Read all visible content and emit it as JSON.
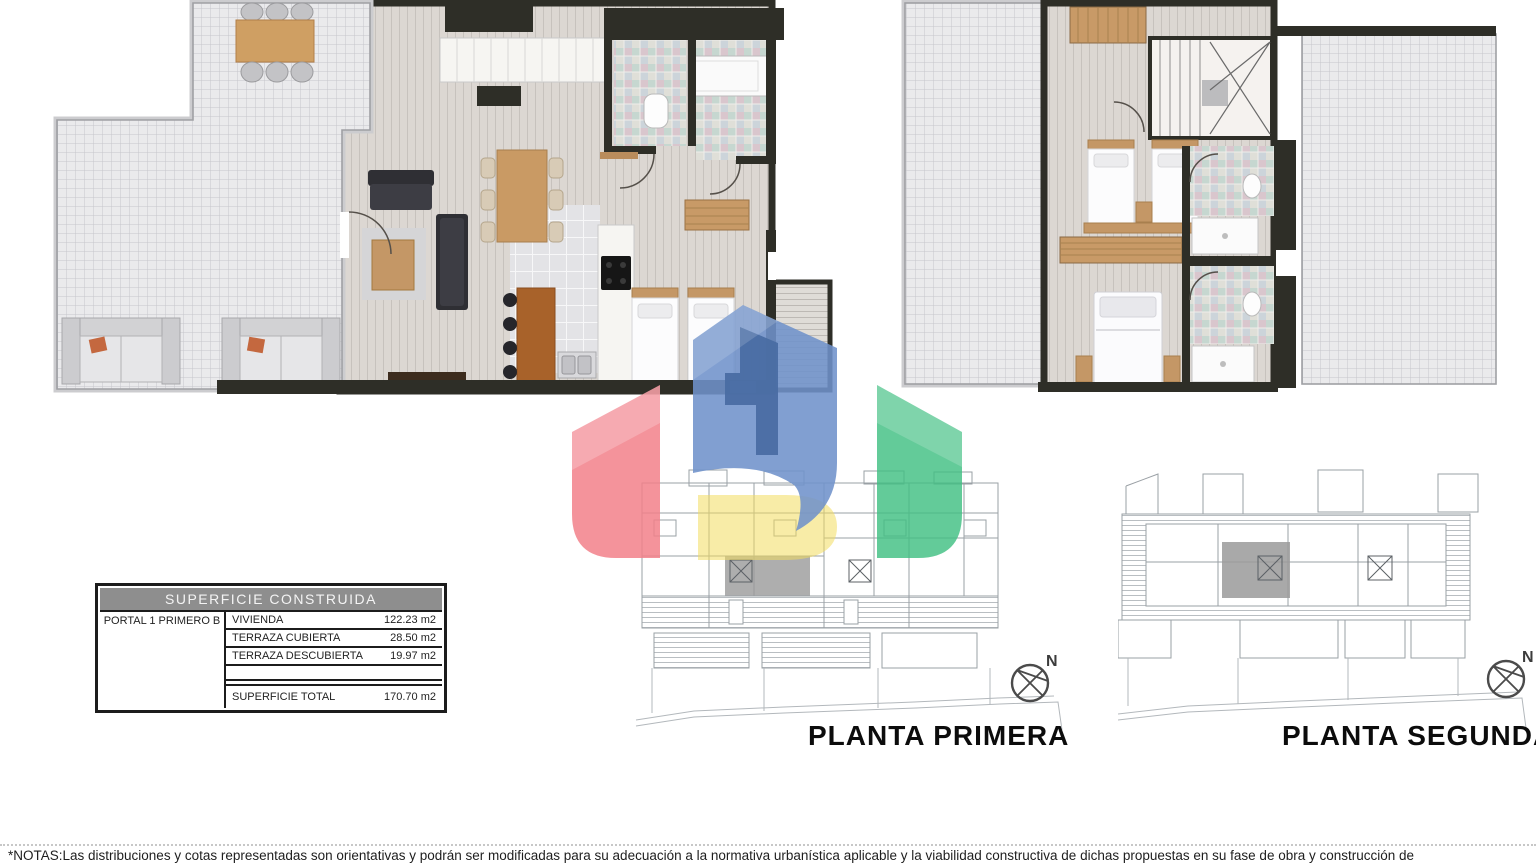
{
  "sheet": {
    "north_label": "N",
    "notes": "*NOTAS:Las distribuciones y cotas representadas son orientativas y podrán ser modificadas para su adecuación a la normativa urbanística aplicable y la viabilidad constructiva de dichas propuestas en su fase de obra y construcción de"
  },
  "area_table": {
    "title": "SUPERFICIE CONSTRUIDA",
    "unit_label": "PORTAL 1 PRIMERO B",
    "rows": [
      {
        "label": "VIVIENDA",
        "value": "122.23 m2"
      },
      {
        "label": "TERRAZA CUBIERTA",
        "value": "28.50 m2"
      },
      {
        "label": "TERRAZA DESCUBIERTA",
        "value": "19.97 m2"
      }
    ],
    "total": {
      "label": "SUPERFICIE TOTAL",
      "value": "170.70 m2"
    }
  },
  "site_plans": [
    {
      "label": "PLANTA PRIMERA"
    },
    {
      "label": "PLANTA SEGUNDA"
    }
  ],
  "logo_colors": {
    "red": "#F2808A",
    "blue": "#7092CB",
    "blue_dark": "#4A6DA3",
    "green": "#41BF83",
    "yellow": "#F2DC5F"
  }
}
